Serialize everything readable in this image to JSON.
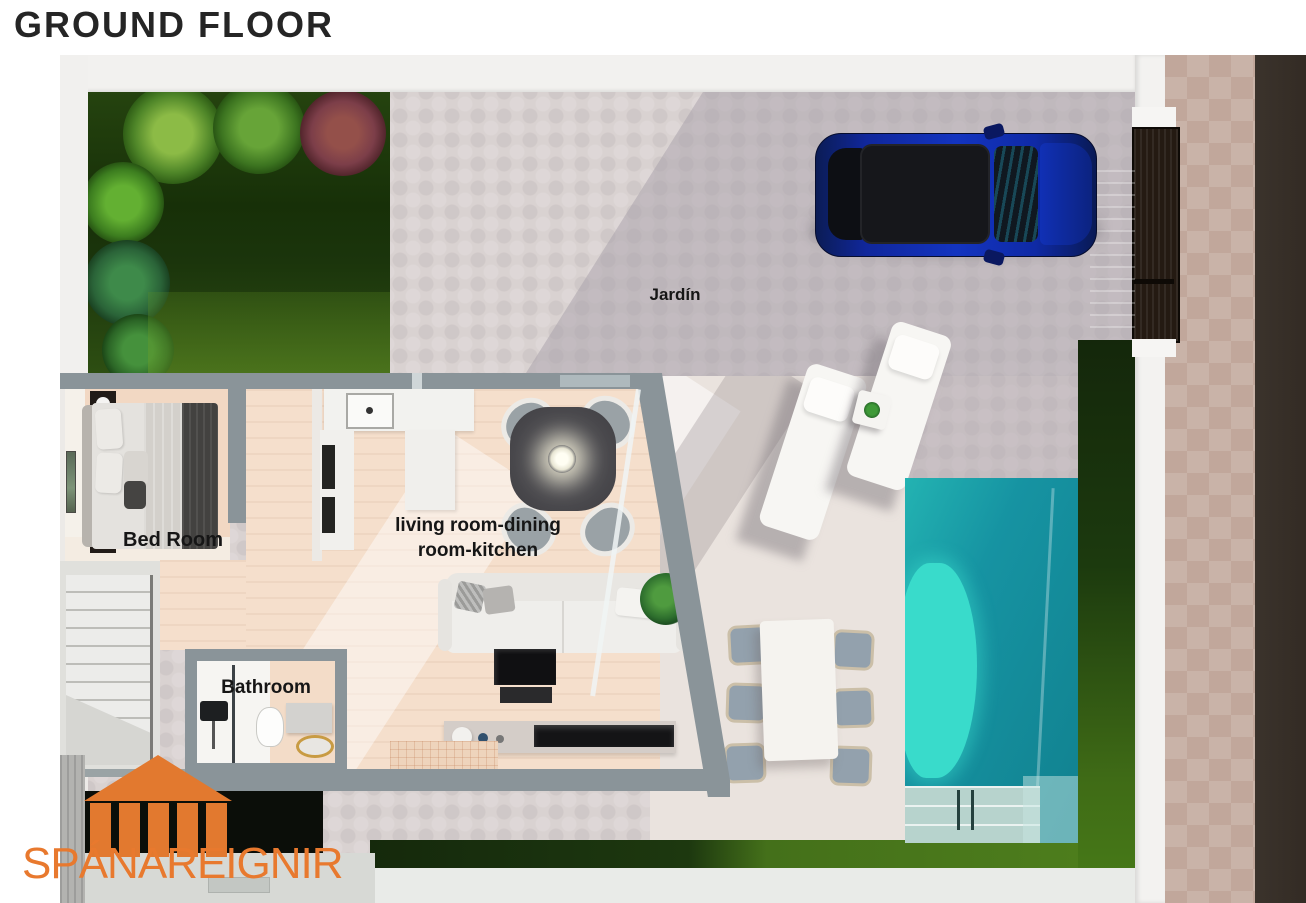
{
  "page": {
    "title": "GROUND FLOOR"
  },
  "floor_plan": {
    "labels": {
      "garden": "Jardín",
      "living_area": "living room-dining room-kitchen",
      "bedroom": "Bed Room",
      "bathroom": "Bathroom"
    },
    "colors": {
      "accent_orange": "#e8792e",
      "wall_gray": "#8a9499",
      "pool_teal": "#1693a2",
      "pool_shallow": "#39dbcb",
      "grass_dark": "#1d380f",
      "grass_bright": "#4d7d1c",
      "car_blue": "#1334c0",
      "wood_floor": "#f5dfcc",
      "patio_gray": "#d9d2d1",
      "road_dark": "#38302a",
      "sidewalk_beige": "#c9b3a8"
    }
  },
  "logo": {
    "text": "SPÁNAREIGNIR",
    "icon": "temple-columns-icon",
    "color": "#e8792e"
  }
}
